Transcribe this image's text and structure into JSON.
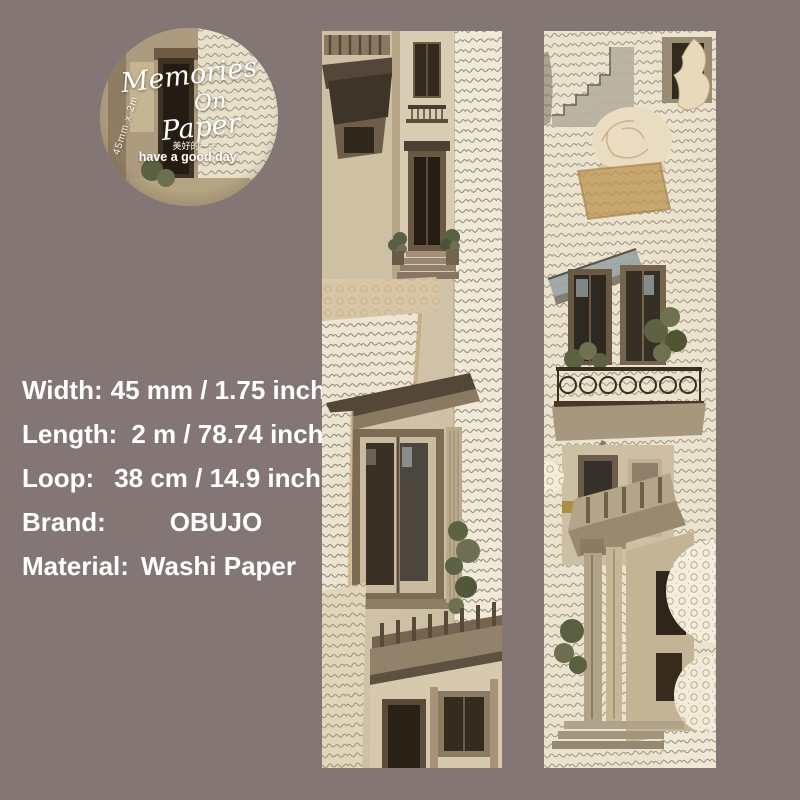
{
  "page": {
    "background": "#847674"
  },
  "badge": {
    "title_line1": "Memories",
    "title_line2": "On",
    "title_line3": "Paper",
    "side_text": "45mm x 2m",
    "cn_text": "美好的一天",
    "tagline": "have a good day."
  },
  "specs": {
    "text_color": "#ffffff",
    "items": [
      {
        "label": "Width:",
        "value": "45 mm / 1.75 inch"
      },
      {
        "label": "Length:",
        "value": "2 m / 78.74 inch"
      },
      {
        "label": "Loop:",
        "value": "38 cm / 14.9 inch"
      },
      {
        "label": "Brand:",
        "value": "OBUJO"
      },
      {
        "label": "Material:",
        "value": "Washi Paper"
      }
    ]
  },
  "tape": {
    "palette": {
      "parchment": "#e9e0cc",
      "script_ink": "#4b443a",
      "dark_wood": "#3a2f22",
      "stone": "#b5a88e",
      "torn_tan": "#c8a76e",
      "lace": "#f3eee0",
      "foliage": "#5c6344"
    }
  }
}
